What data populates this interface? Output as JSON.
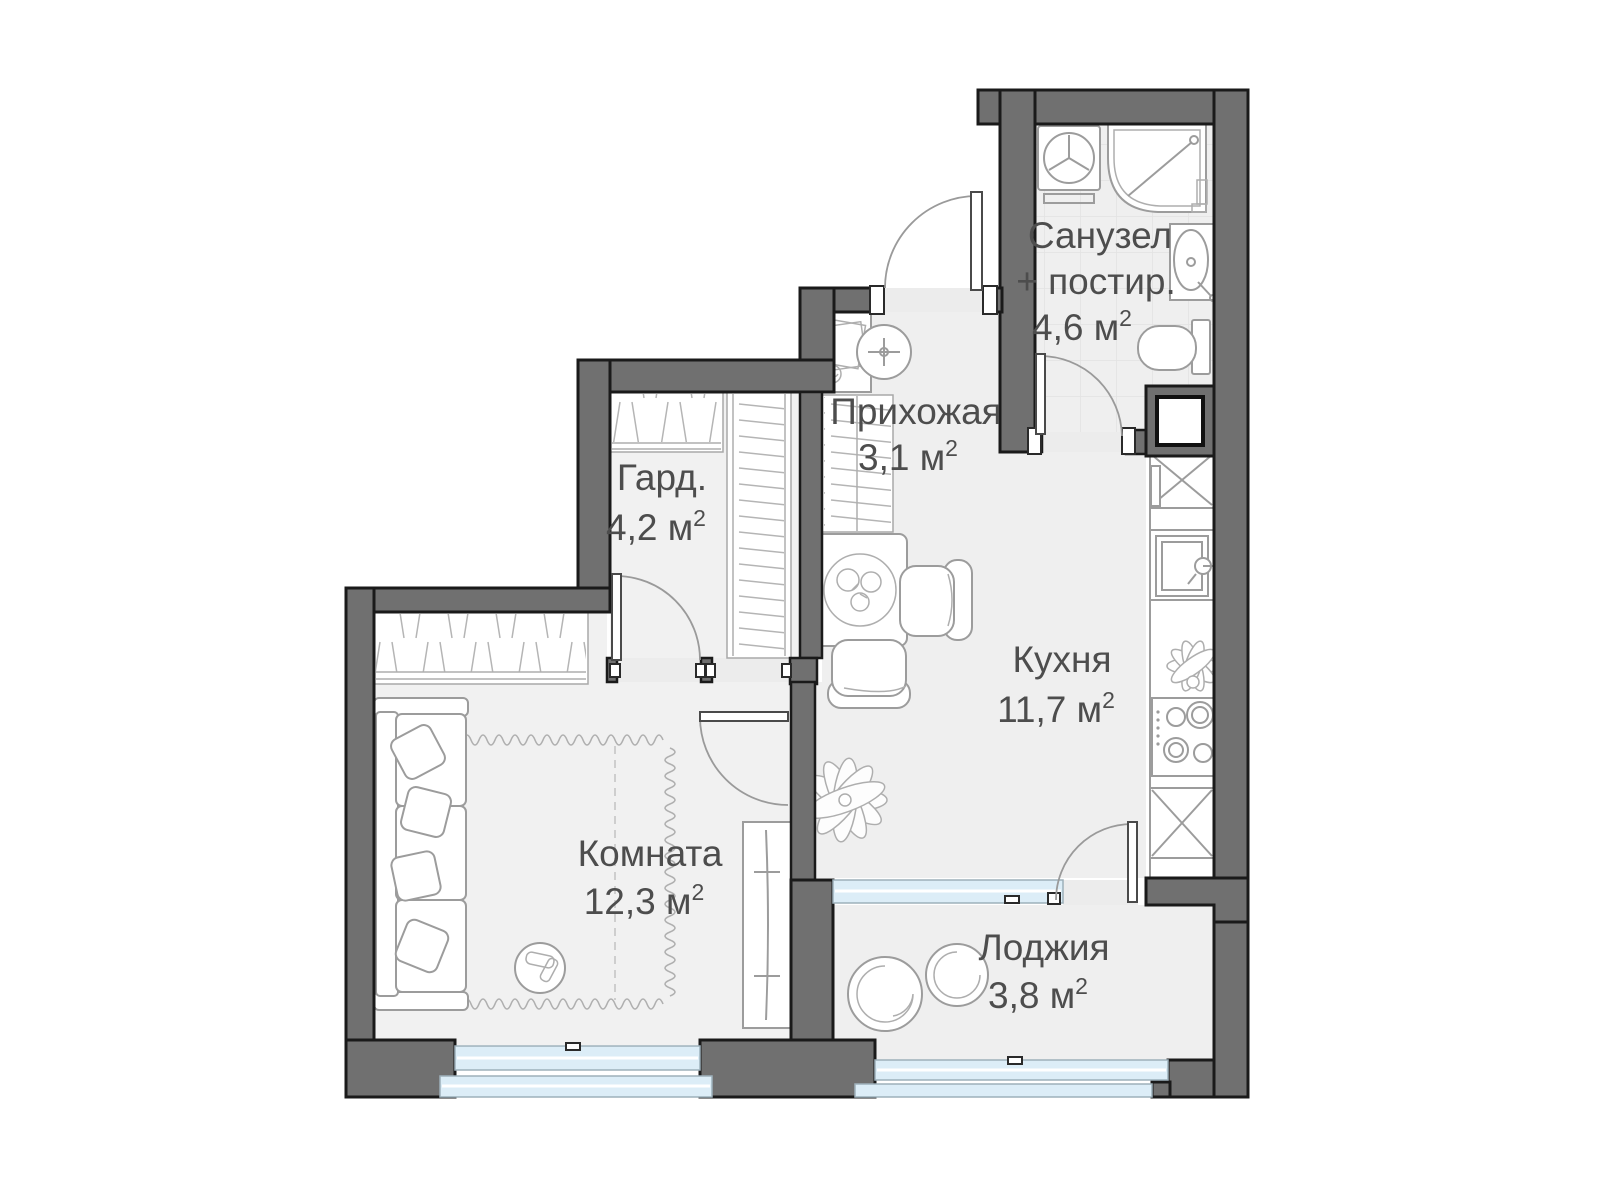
{
  "title": "Floor plan — studio apartment",
  "rooms": {
    "bathroom": {
      "name_line1": "Санузел",
      "name_line2": "+ постир.",
      "area": "4,6"
    },
    "hallway": {
      "name": "Прихожая",
      "area": "3,1"
    },
    "wardrobe": {
      "name": "Гард.",
      "area": "4,2"
    },
    "kitchen": {
      "name": "Кухня",
      "area": "11,7"
    },
    "room": {
      "name": "Комната",
      "area": "12,3"
    },
    "loggia": {
      "name": "Лоджия",
      "area": "3,8"
    }
  },
  "units": {
    "suffix": " м",
    "sup": "2"
  },
  "colors": {
    "wall": "#707070",
    "wall_outline": "#1a1a1a",
    "floor": "#efefef",
    "glazing": "#dcedf7",
    "furniture_stroke": "#9c9c9c",
    "label_text": "#4d4d4d",
    "background": "#ffffff"
  },
  "fixtures": [
    "washing-machine",
    "corner-bathtub",
    "washbasin",
    "toilet",
    "hall-vanity",
    "round-basin",
    "hall-closet",
    "wardrobe-rails",
    "dining-table",
    "chair",
    "chair",
    "plant",
    "kitchen-counter",
    "kitchen-sink",
    "stove",
    "base-cabinet",
    "base-cabinet",
    "sofa",
    "pouf",
    "rug",
    "tall-cabinet",
    "loggia-chair",
    "loggia-chair",
    "entry-door",
    "bathroom-door",
    "wardrobe-door",
    "room-door",
    "balcony-door",
    "window",
    "window",
    "window",
    "ventilation-shaft"
  ]
}
